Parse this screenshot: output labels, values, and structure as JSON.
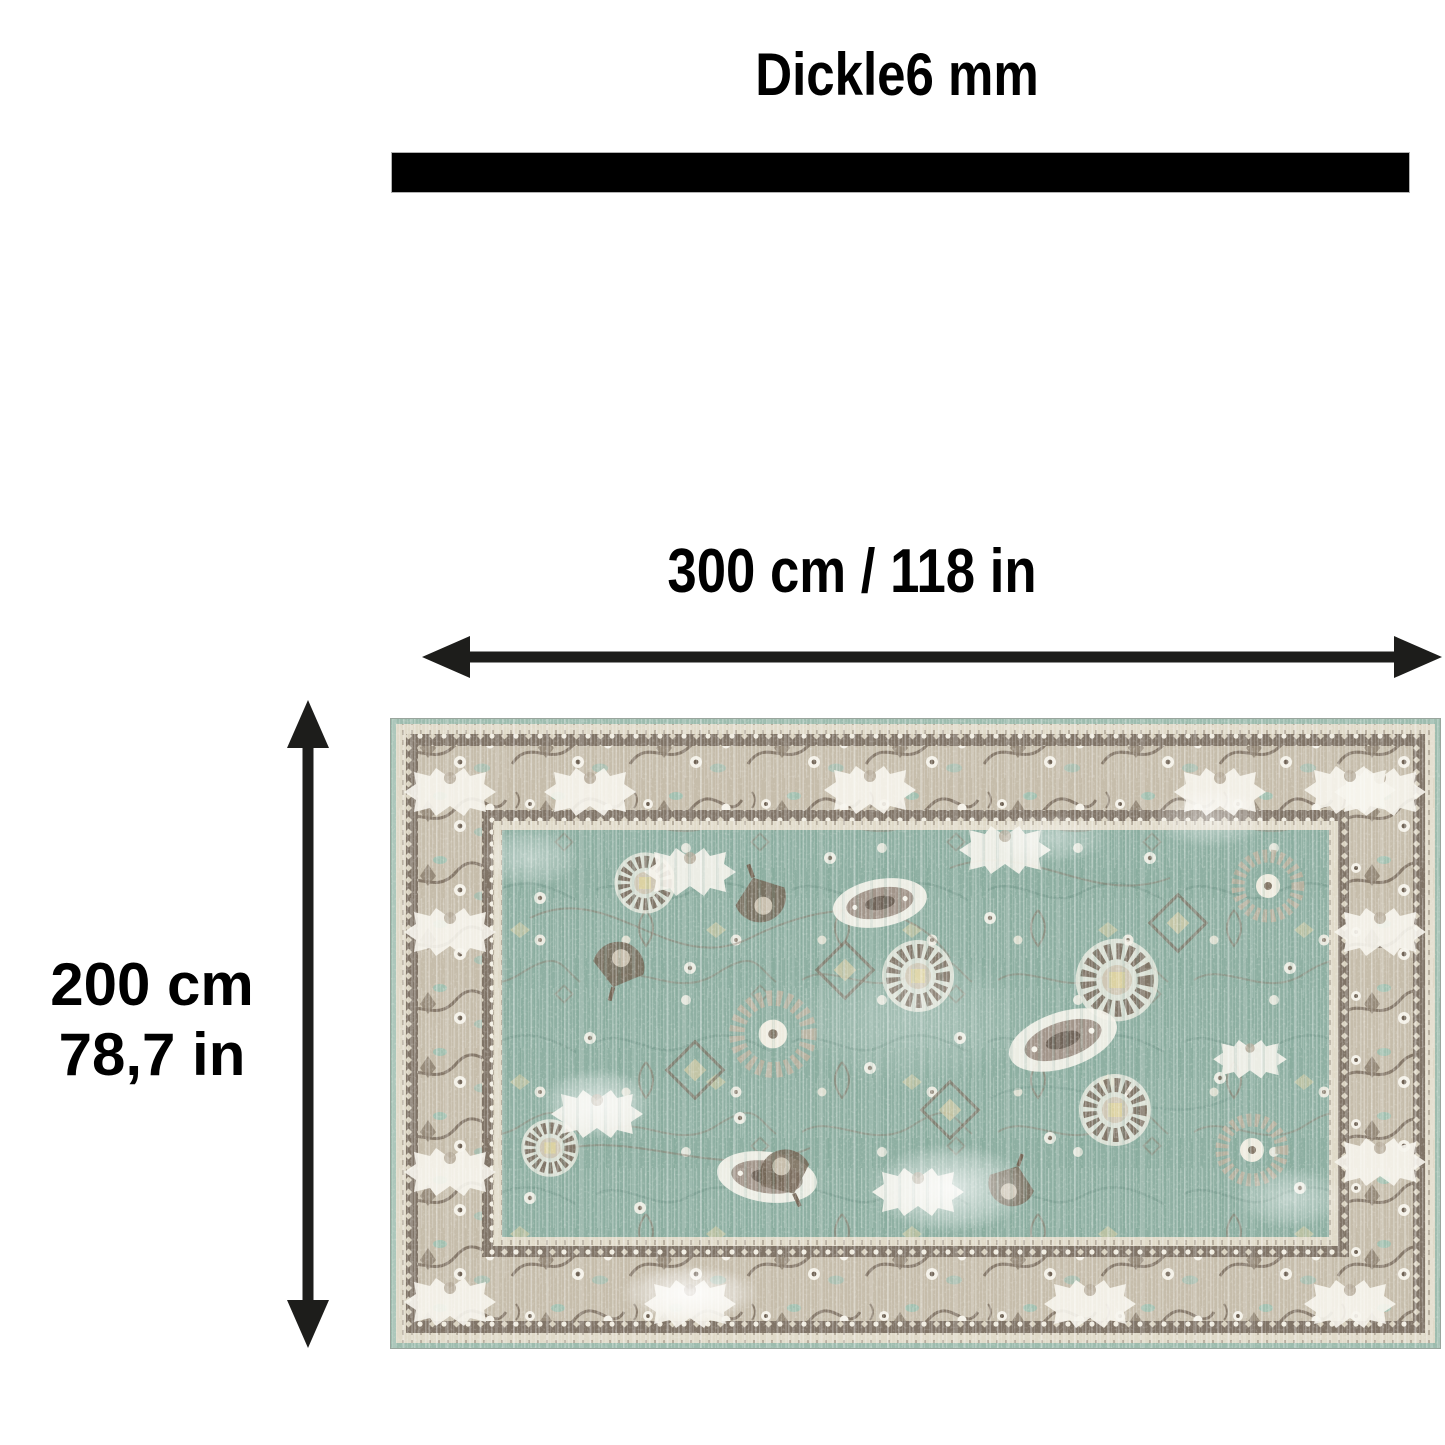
{
  "diagram": {
    "title": "Dickle6 mm",
    "width_label": "300 cm / 118 in",
    "height_label_line1": "200 cm",
    "height_label_line2": "78,7 in",
    "icons": {
      "thickness_bar": "solid-black-thickness-bar",
      "width_arrow": "horizontal-double-headed-arrow",
      "height_arrow": "vertical-double-headed-arrow"
    },
    "product_image": "vintage-oushak-style-rug-teal-field-beige-border"
  },
  "colors": {
    "background": "#ffffff",
    "text": "#000000",
    "arrow": "#1d1d1b",
    "bar": "#000000",
    "rug_field_teal": "#8fb0a3",
    "rug_border_beige": "#c6bdab",
    "rug_motif_dark_brown": "#6e6153",
    "rug_motif_cream": "#f4f1e8",
    "rug_accent_gold": "#d9cd9d"
  }
}
